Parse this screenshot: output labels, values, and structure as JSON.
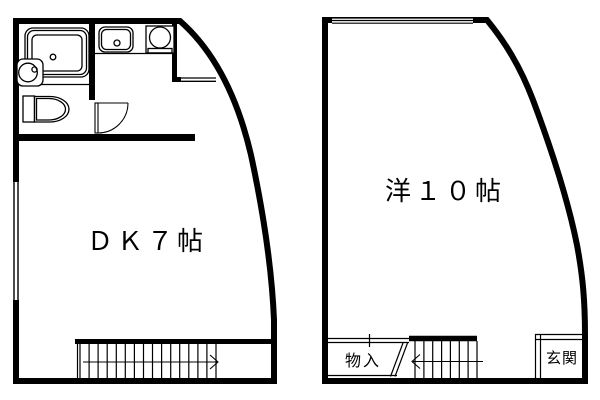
{
  "page": {
    "background_color": "#ffffff",
    "line_color": "#000000"
  },
  "left_unit": {
    "room_label": "ＤＫ７帖",
    "fixtures": {
      "bathtub": "bathtub-icon",
      "washbasin": "washbasin-icon",
      "toilet": "toilet-icon",
      "kitchen_sink": "kitchen-sink-icon",
      "stove": "stove-icon",
      "door": "door-swing-icon",
      "stairs": "staircase-icon",
      "stairs_arrow": "right-arrow-icon",
      "window": "window-icon"
    }
  },
  "right_unit": {
    "room_label": "洋１０帖",
    "closet_label": "物入",
    "entrance_label": "玄関",
    "fixtures": {
      "stairs": "staircase-icon",
      "stairs_arrow": "left-arrow-icon",
      "window": "window-icon"
    }
  }
}
